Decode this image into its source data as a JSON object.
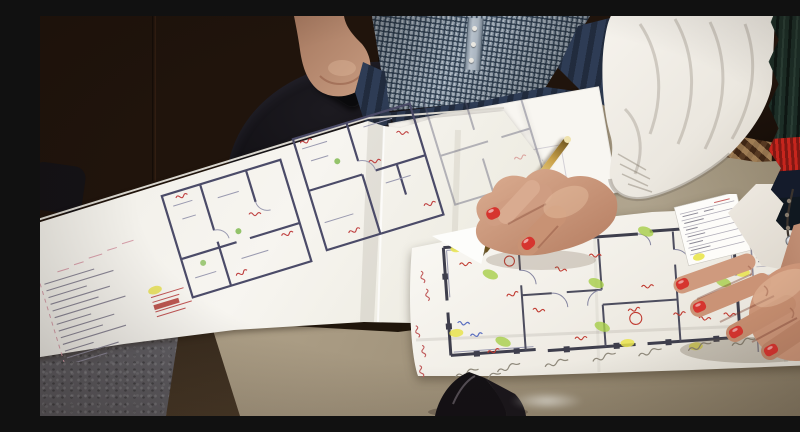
{
  "scene": {
    "type": "photograph",
    "description": "Two people stand at a table reviewing hand-annotated architectural floor plans; a woman with red-painted nails writes on a plan with a gold pen while a man in a checked shirt holds a black phone",
    "setting": "meeting room with dark wood paneling and a black office chair",
    "people": [
      {
        "id": "man",
        "visible": "torso and left forearm",
        "clothing": "blue-gray gingham button shirt, dark jeans",
        "holding": "black mobile phone"
      },
      {
        "id": "woman",
        "visible": "both arms and hands",
        "clothing": "white crinkled blouse, dark green knit scarf with red and navy stripes",
        "nails": "red polish",
        "holding": "gold ballpoint pen",
        "jewelry": "necklace strands with silver pendant"
      }
    ],
    "objects": [
      {
        "name": "upper-floorplan-sheet",
        "detail": "folded multi-panel floor plan with left title block, pink revision strips and red stamp"
      },
      {
        "name": "paper-stack",
        "detail": "loose white sheets with faint plan linework"
      },
      {
        "name": "lower-floorplan-sheet",
        "detail": "large floor plan marked with green and yellow highlighter, red pen notes, blue marks, pencil labels along the fold and a legend table at right"
      },
      {
        "name": "sunglasses",
        "detail": "black folded sunglasses at bottom edge of table"
      },
      {
        "name": "felt-fabric",
        "detail": "gray felt bag in lower-left corner"
      },
      {
        "name": "table",
        "detail": "taupe laminate table top"
      }
    ]
  },
  "palette": {
    "wood": "#4a2a18",
    "chair": "#0e0d10",
    "shirt": "#93a1af",
    "jeans": "#2e3c55",
    "skin": "#c1917a",
    "blouse": "#efece6",
    "scarf_green": "#1c2d26",
    "scarf_red": "#c6251d",
    "scarf_navy": "#141b2b",
    "table": "#a89a82",
    "felt": "#605e63",
    "paper": "#f6f4ef",
    "plan_line": "#3e3e4c",
    "highlight_green": "#a8cf4a",
    "highlight_yellow": "#e9e44e",
    "ink_red": "#c03a30",
    "ink_blue": "#5b6fc0",
    "pencil": "#8f897b",
    "pen_gold": "#d4b05c",
    "nails": "#d6352f"
  }
}
